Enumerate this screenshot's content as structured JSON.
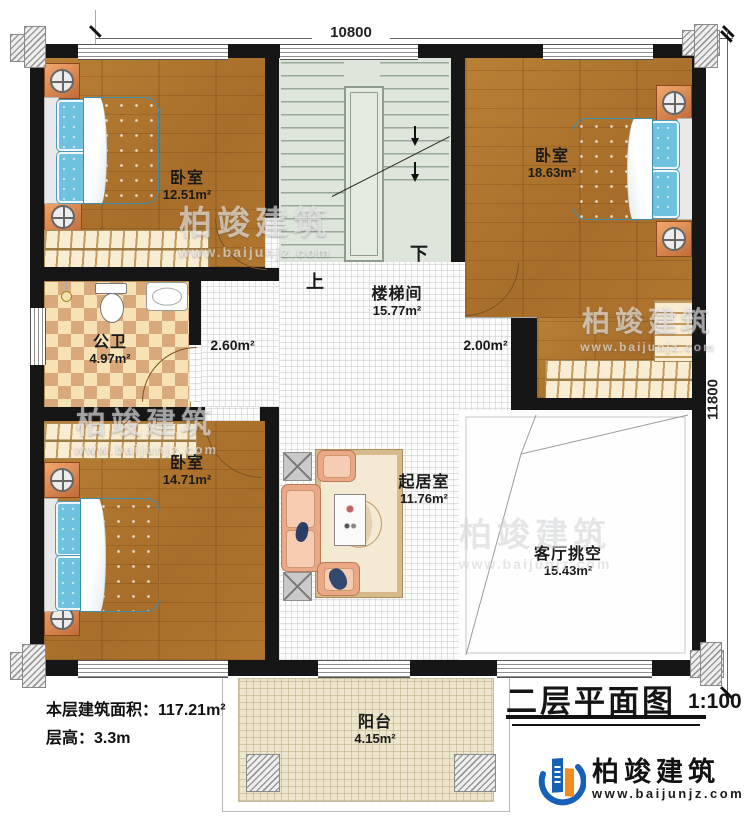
{
  "title_block": {
    "title": "二层平面图",
    "scale": "1:100"
  },
  "dimensions": {
    "width_label": "10800",
    "height_label": "11800"
  },
  "rooms": [
    {
      "id": "bedroom-top-left",
      "name": "卧室",
      "area": "12.51m²"
    },
    {
      "id": "stairwell",
      "name": "楼梯间",
      "area": "15.77m²"
    },
    {
      "id": "bedroom-top-right",
      "name": "卧室",
      "area": "18.63m²"
    },
    {
      "id": "bathroom",
      "name": "公卫",
      "area": "4.97m²"
    },
    {
      "id": "hall-left",
      "name": "",
      "area": "2.60m²"
    },
    {
      "id": "hall-right",
      "name": "",
      "area": "2.00m²"
    },
    {
      "id": "bedroom-bottom-left",
      "name": "卧室",
      "area": "14.71m²"
    },
    {
      "id": "living-room",
      "name": "起居室",
      "area": "11.76m²"
    },
    {
      "id": "void",
      "name": "客厅挑空",
      "area": "15.43m²"
    },
    {
      "id": "balcony",
      "name": "阳台",
      "area": "4.15m²"
    }
  ],
  "stairs": {
    "up_label": "上",
    "down_label": "下"
  },
  "info": {
    "line1_label": "本层建筑面积：",
    "line1_value": "117.21m²",
    "line2_label": "层高：",
    "line2_value": "3.3m"
  },
  "brand": {
    "name": "柏竣建筑",
    "website": "www.baijunjz.com"
  },
  "watermark": {
    "text": "柏竣建筑",
    "url": "www.baijunjz.com"
  },
  "colors": {
    "wall": "#161616",
    "wood": "#b0772f",
    "stair_green": "#dee6dc",
    "tile_light": "#f6e2b4",
    "tile_dark": "#d9a97b",
    "bed_blue": "#64bcdc",
    "furniture_orange": "#e8925a",
    "sofa_salmon": "#eaa887",
    "logo_blue": "#1660b8",
    "logo_orange": "#f28a1e"
  }
}
